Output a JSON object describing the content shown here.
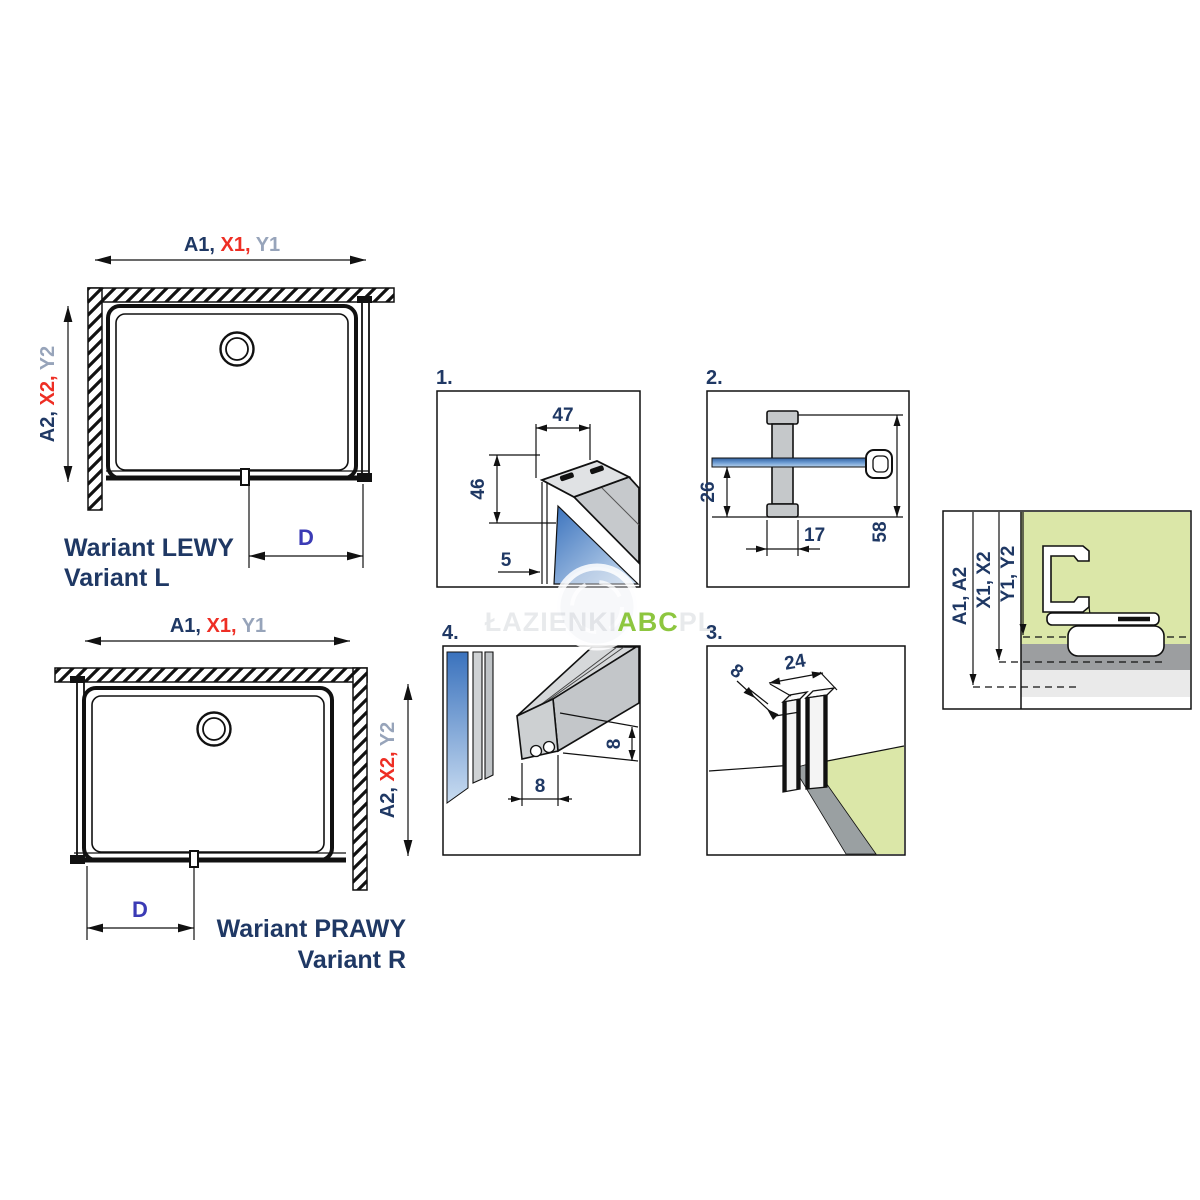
{
  "watermark": {
    "prefix": "ŁAZIENKI",
    "highlight": "ABC",
    "suffix": "PL"
  },
  "colors": {
    "navy": "#1f3864",
    "red": "#ee2e24",
    "gray": "#97a4ba",
    "dim_blue": "#3b3bb5",
    "accent_green": "#8dc63f",
    "glass_blue": "#3a72bd",
    "glass_blue_light": "#b8d2ec",
    "wall_green": "#dbe7a8",
    "profile_gray": "#c5c8ca",
    "strip_gray": "#9aa0a2"
  },
  "variant_l": {
    "width_label": {
      "a": "A1, ",
      "x": "X1, ",
      "y": "Y1"
    },
    "height_label": {
      "a": "A2, ",
      "x": "X2, ",
      "y": "Y2"
    },
    "door_label": "D",
    "title_line1": "Wariant LEWY",
    "title_line2": "Variant L"
  },
  "variant_r": {
    "width_label": {
      "a": "A1, ",
      "x": "X1, ",
      "y": "Y1"
    },
    "height_label": {
      "a": "A2, ",
      "x": "X2, ",
      "y": "Y2"
    },
    "door_label": "D",
    "title_line1": "Wariant PRAWY",
    "title_line2": "Variant R"
  },
  "details": {
    "d1": {
      "number": "1.",
      "dim_top": "47",
      "dim_side": "46",
      "dim_gap": "5"
    },
    "d2": {
      "number": "2.",
      "dim_offset": "26",
      "dim_clamp": "17",
      "dim_total": "58"
    },
    "d3": {
      "number": "3.",
      "dim_top": "24",
      "dim_glass": "8"
    },
    "d4": {
      "number": "4.",
      "dim_bottom": "8",
      "dim_side": "8"
    }
  },
  "profile_section": {
    "label_a": "A1, A2",
    "label_x": "X1, X2",
    "label_y": "Y1, Y2"
  }
}
